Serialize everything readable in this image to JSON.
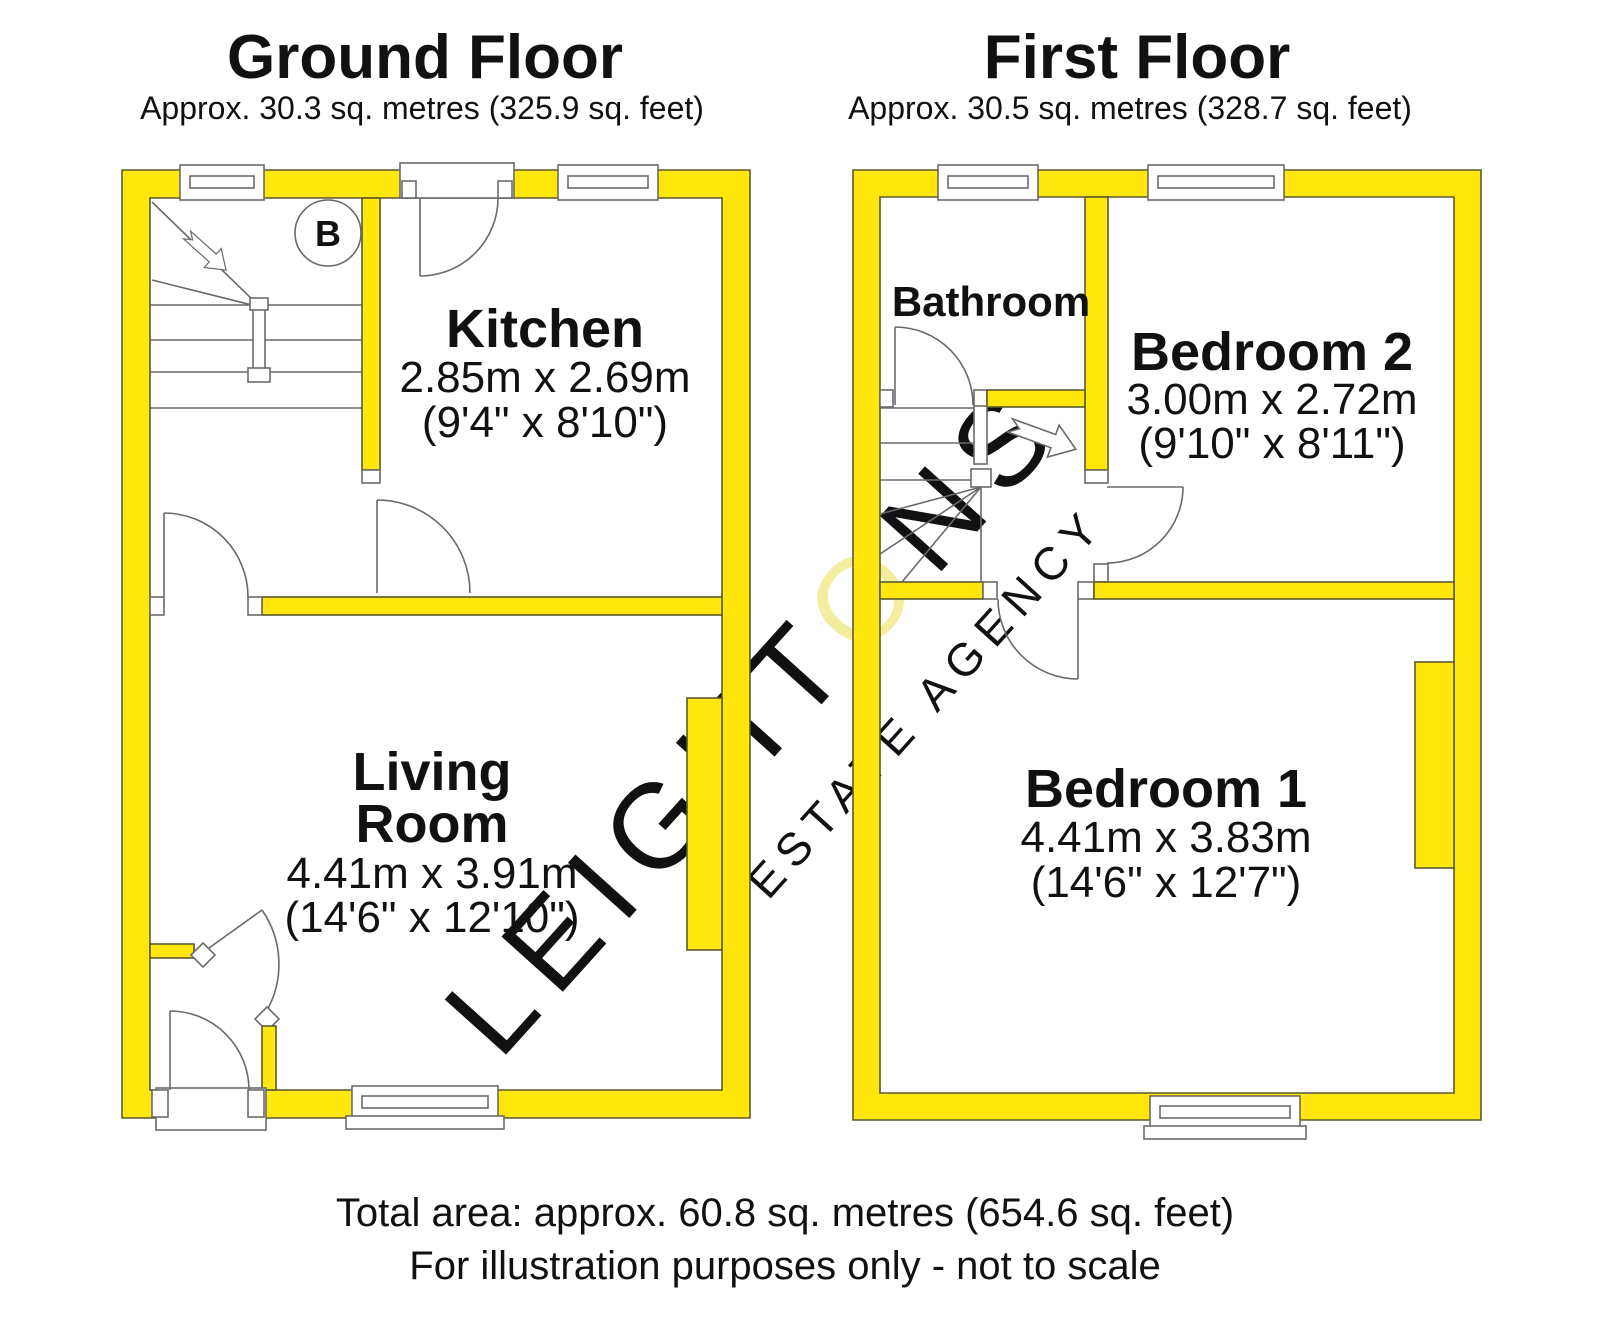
{
  "ground_floor": {
    "title": "Ground Floor",
    "subtitle": "Approx. 30.3 sq. metres (325.9 sq. feet)",
    "boiler_label": "B",
    "rooms": {
      "kitchen": {
        "name": "Kitchen",
        "dim_metric": "2.85m x 2.69m",
        "dim_imperial": "(9'4\" x 8'10\")"
      },
      "living": {
        "name_line1": "Living",
        "name_line2": "Room",
        "dim_metric": "4.41m x 3.91m",
        "dim_imperial": "(14'6\" x 12'10\")"
      }
    }
  },
  "first_floor": {
    "title": "First Floor",
    "subtitle": "Approx. 30.5 sq. metres (328.7 sq. feet)",
    "rooms": {
      "bathroom": {
        "name": "Bathroom"
      },
      "bedroom2": {
        "name": "Bedroom 2",
        "dim_metric": "3.00m x 2.72m",
        "dim_imperial": "(9'10\" x 8'11\")"
      },
      "bedroom1": {
        "name": "Bedroom 1",
        "dim_metric": "4.41m x 3.83m",
        "dim_imperial": "(14'6\" x 12'7\")"
      }
    }
  },
  "watermark": {
    "part1": "LEIGHT",
    "part2": "O",
    "part3": "NS",
    "line2": "ESTATE AGENCY"
  },
  "footer": {
    "total_area": "Total area: approx. 60.8 sq. metres (654.6 sq. feet)",
    "disclaimer": "For illustration purposes only - not to scale"
  },
  "colors": {
    "wall_fill": "#ffe60d",
    "outline": "#5a5a30",
    "watermark_gray": "#c9c9c9",
    "watermark_yellow": "#f3eda0"
  }
}
